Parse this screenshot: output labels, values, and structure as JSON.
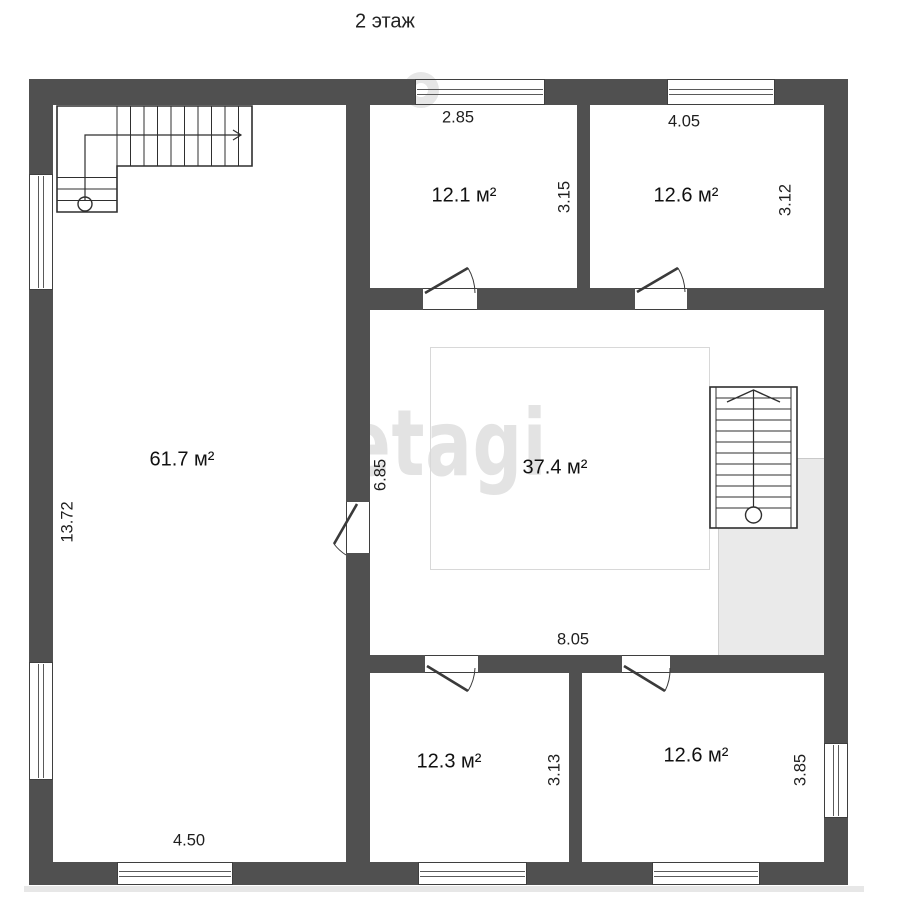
{
  "title": "2 этаж",
  "watermark": "etagi",
  "colors": {
    "wall": "#505050",
    "shade": "#eaeaea",
    "watermark": "#e3e3e3"
  },
  "rooms": [
    {
      "id": "12-1",
      "area": "12.1 м²",
      "width": "2.85",
      "height": "3.15"
    },
    {
      "id": "12-6-top",
      "area": "12.6 м²",
      "width": "4.05",
      "height": "3.12"
    },
    {
      "id": "61-7",
      "area": "61.7 м²",
      "width": "4.50",
      "height": "13.72"
    },
    {
      "id": "37-4",
      "area": "37.4 м²",
      "width": "8.05",
      "height": "6.85"
    },
    {
      "id": "12-3",
      "area": "12.3 м²",
      "height": "3.13"
    },
    {
      "id": "12-6-bottom",
      "area": "12.6 м²",
      "height": "3.85"
    }
  ]
}
